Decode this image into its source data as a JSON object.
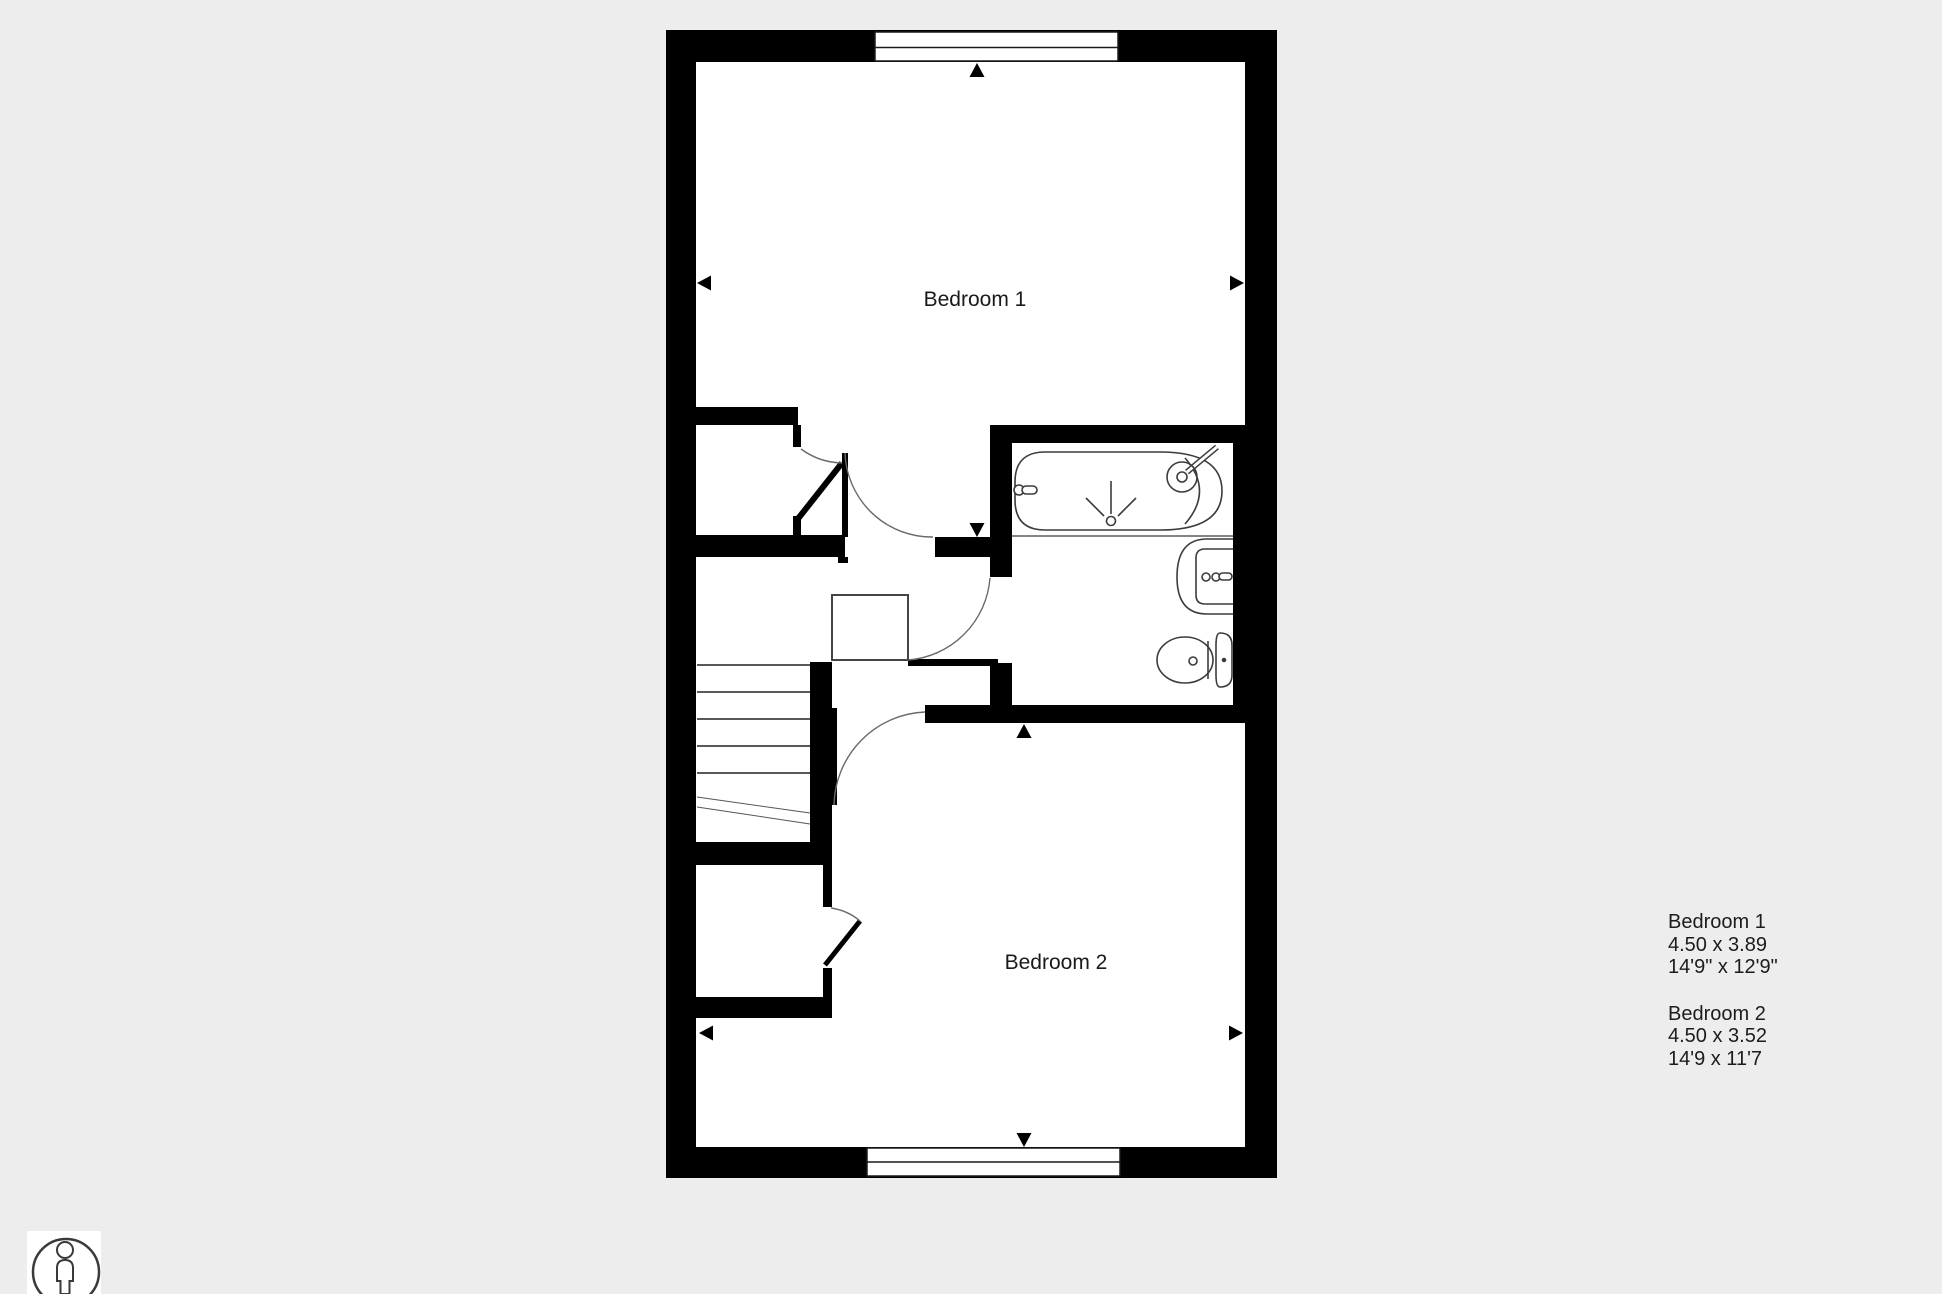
{
  "colors": {
    "background": "#ededed",
    "wall": "#000000",
    "fixture_line": "#3c3c3c",
    "door_arc": "#6a6a6a",
    "text": "#1c1c1c"
  },
  "rooms": {
    "bedroom1": {
      "label": "Bedroom 1"
    },
    "bedroom2": {
      "label": "Bedroom 2"
    }
  },
  "legend": {
    "items": [
      {
        "name": "Bedroom 1",
        "metric": "4.50 x 3.89",
        "imperial": "14'9\" x 12'9\""
      },
      {
        "name": "Bedroom 2",
        "metric": "4.50 x 3.52",
        "imperial": "14'9 x 11'7"
      }
    ]
  },
  "icons": {
    "person": "person-figure-icon"
  }
}
